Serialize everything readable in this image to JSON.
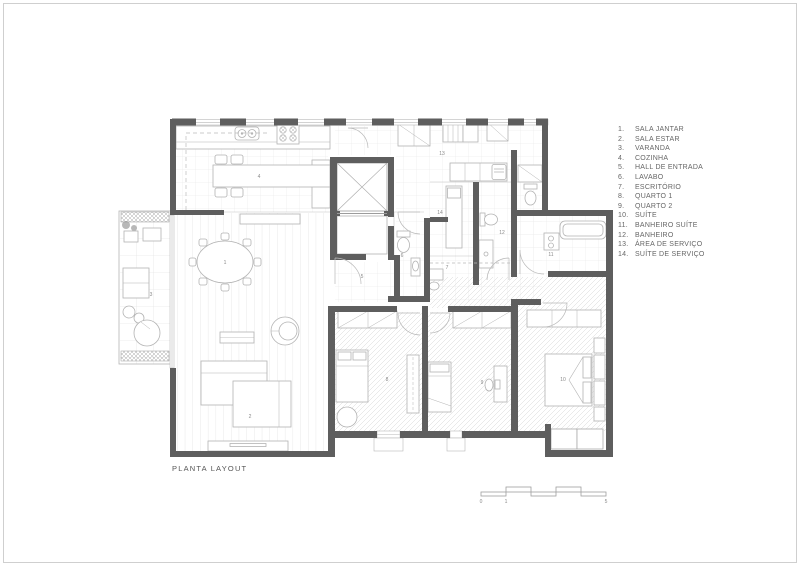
{
  "drawing": {
    "title": "PLANTA LAYOUT",
    "scale_bar": {
      "start_label": "0",
      "mid_label": "1",
      "end_label": "5"
    }
  },
  "legend": {
    "items": [
      {
        "num": "1.",
        "label": "SALA JANTAR"
      },
      {
        "num": "2.",
        "label": "SALA ESTAR"
      },
      {
        "num": "3.",
        "label": "VARANDA"
      },
      {
        "num": "4.",
        "label": "COZINHA"
      },
      {
        "num": "5.",
        "label": "HALL DE ENTRADA"
      },
      {
        "num": "6.",
        "label": "LAVABO"
      },
      {
        "num": "7.",
        "label": "ESCRITÓRIO"
      },
      {
        "num": "8.",
        "label": "QUARTO 1"
      },
      {
        "num": "9.",
        "label": "QUARTO 2"
      },
      {
        "num": "10.",
        "label": "SUÍTE"
      },
      {
        "num": "11.",
        "label": "BANHEIRO SUÍTE"
      },
      {
        "num": "12.",
        "label": "BANHEIRO"
      },
      {
        "num": "13.",
        "label": "ÁREA DE SERVIÇO"
      },
      {
        "num": "14.",
        "label": "SUÍTE DE SERVIÇO"
      }
    ]
  },
  "plan_labels": {
    "r1": "1",
    "r2": "2",
    "r3": "3",
    "r4": "4",
    "r5": "5",
    "r6": "6",
    "r7": "7",
    "r8": "8",
    "r9": "9",
    "r10": "10",
    "r11": "11",
    "r12": "12",
    "r13": "13",
    "r14": "14"
  },
  "colors": {
    "wall": "#5e5e5e",
    "furniture_line": "#b3b3b3",
    "text": "#666666"
  }
}
